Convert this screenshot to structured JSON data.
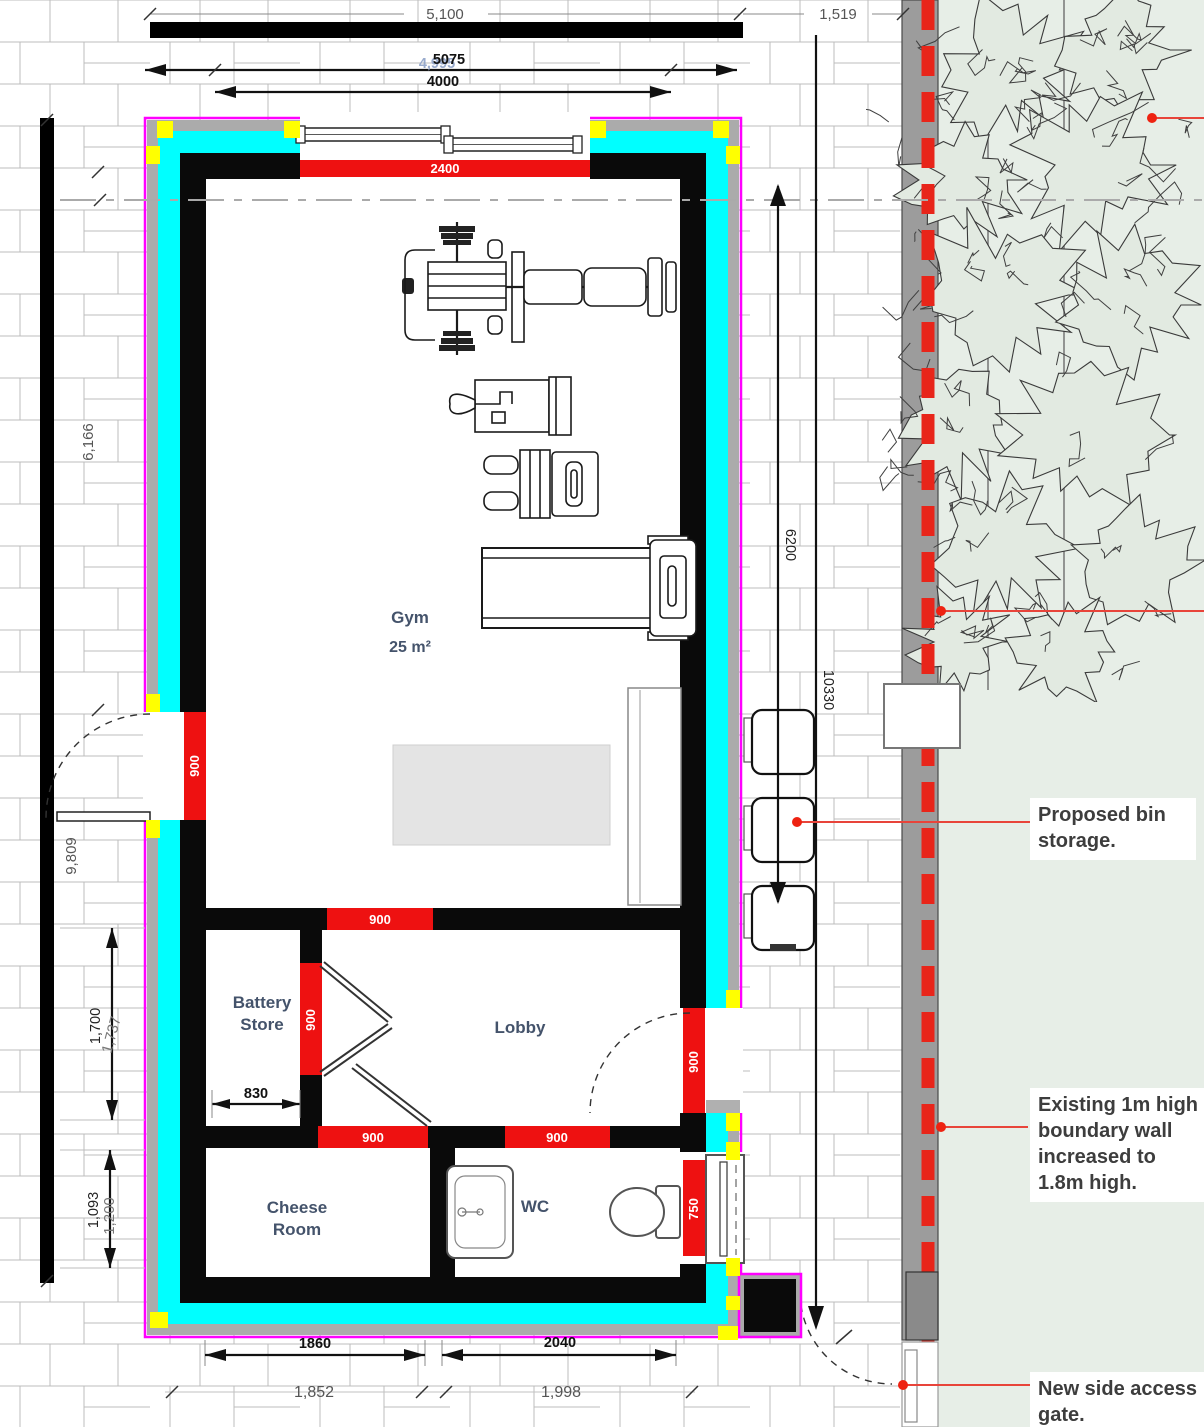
{
  "plan": {
    "rooms": {
      "gym": {
        "label": "Gym",
        "area": "25 m²"
      },
      "battery_store": {
        "line1": "Battery",
        "line2": "Store"
      },
      "lobby": {
        "label": "Lobby"
      },
      "cheese_room": {
        "line1": "Cheese",
        "line2": "Room"
      },
      "wc": {
        "label": "WC"
      }
    },
    "dimensions": {
      "top_wall": "5,100",
      "top_right": "1,519",
      "overall_width": "5075",
      "overall_width_alt": "4,995",
      "inner_width": "4000",
      "left_upper": "6,166",
      "left_outer": "9,809",
      "right_inner": "6200",
      "right_outer": "10330",
      "opening_top": "2400",
      "door_left": "900",
      "door_gym_lobby": "900",
      "door_battery": "900",
      "door_lobby_right": "900",
      "door_cheese": "900",
      "door_wc": "900",
      "window_wc": "750",
      "battery_width": "830",
      "battery_height": "1,700",
      "battery_height_alt": "1,737",
      "cheese_height": "1,093",
      "cheese_height_alt": "1,200",
      "bottom_door_left": "1860",
      "bottom_door_right": "2040",
      "bottom_left_alt": "1,852",
      "bottom_right_alt": "1,998"
    },
    "annotations": {
      "bin_storage": "Proposed bin storage.",
      "boundary_wall": "Existing 1m high boundary wall increased to 1.8m high.",
      "side_gate": "New side access gate."
    },
    "colors": {
      "wall_black": "#0a0a0a",
      "insulation_cyan": "#00ffff",
      "outline_magenta": "#ff00ff",
      "band_gray": "#ababab",
      "marker_yellow": "#ffff00",
      "door_red": "#ee1111",
      "leader_red": "#e8443a",
      "boundary_red": "#e8251a",
      "green_area": "#e7eee7",
      "label_blue": "#44536b"
    }
  }
}
